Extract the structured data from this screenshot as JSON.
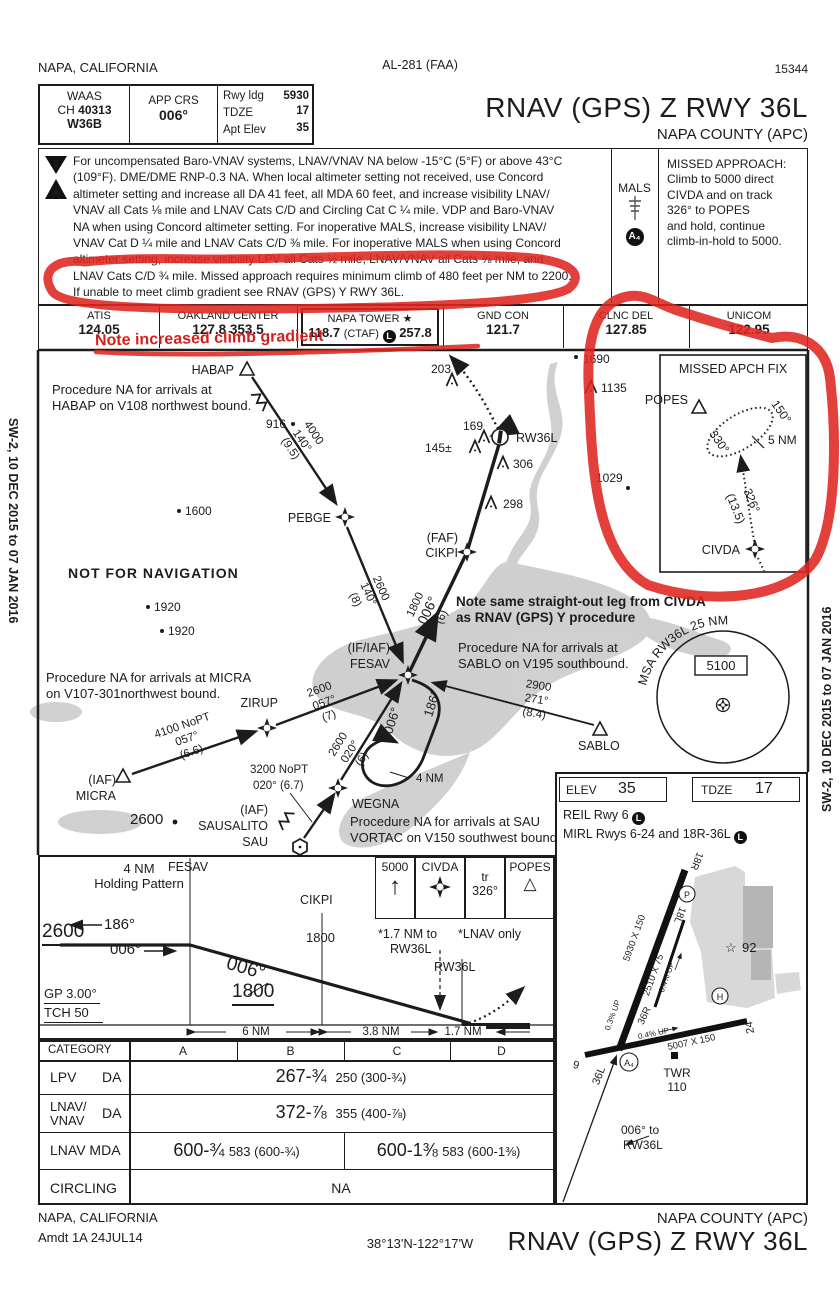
{
  "colors": {
    "red_marker": "#e02520",
    "red_print": "#d02420",
    "terrain": "#c9c9c9"
  },
  "margin": {
    "top_left": "NAPA, CALIFORNIA",
    "top_center": "AL-281 (FAA)",
    "top_right": "15344",
    "side_left": "SW-2, 10 DEC 2015 to 07 JAN 2016",
    "side_right": "SW-2, 10 DEC 2015 to 07 JAN 2016"
  },
  "header": {
    "waas": "WAAS",
    "ch_label": "CH",
    "ch_value": "40313",
    "waas_id": "W36B",
    "app_crs_label": "APP CRS",
    "app_crs_value": "006°",
    "rwy_ldg_label": "Rwy ldg",
    "rwy_ldg_value": "5930",
    "tdze_label": "TDZE",
    "tdze_value": "17",
    "apt_elev_label": "Apt Elev",
    "apt_elev_value": "35",
    "title": "RNAV (GPS) Z RWY 36L",
    "subtitle": "NAPA COUNTY (APC)"
  },
  "notes": {
    "t_icon": "T",
    "a_icon": "A",
    "lines": [
      "For uncompensated Baro-VNAV systems, LNAV/VNAV NA below -15°C (5°F) or above 43°C",
      "(109°F).  DME/DME RNP-0.3 NA.  When local altimeter setting not received, use Concord",
      "altimeter setting and increase all DA 41 feet, all MDA 60 feet, and increase visibility LNAV/",
      "VNAV all Cats ⅛ mile and LNAV Cats C/D and Circling Cat C ¼ mile.  VDP and  Baro-VNAV",
      "NA when using Concord altimeter setting.  For inoperative MALS, increase visibility LNAV/",
      "VNAV Cat D ¼ mile and LNAV Cats C/D ⅜ mile.  For inoperative MALS when using Concord",
      "altimeter setting, increase visibility LPV all Cats ½ mile, LNAV/VNAV all Cats ⅜ mile, and",
      "LNAV Cats C/D ¾ mile.  Missed approach requires minimum climb of 480 feet per NM to 2200.",
      "If unable to meet climb gradient see RNAV (GPS) Y RWY 36L."
    ],
    "mals": "MALS",
    "a4": "A₄",
    "missed_lines": [
      "MISSED APPROACH:",
      "Climb to 5000 direct",
      "CIVDA and on track",
      "326° to POPES",
      "and hold, continue",
      "climb-in-hold to 5000."
    ]
  },
  "freqs": {
    "atis_label": "ATIS",
    "atis": "124.05",
    "center_label": "OAKLAND CENTER",
    "center": "127.8 353.5",
    "tower_label": "NAPA TOWER",
    "tower_star": "★",
    "tower_pre": "118.7",
    "tower_ctaf": "(CTAF)",
    "tower_l": "L",
    "tower_post": "257.8",
    "gnd_label": "GND CON",
    "gnd": "121.7",
    "clnc_label": "CLNC DEL",
    "clnc": "127.85",
    "unicom_label": "UNICOM",
    "unicom": "122.95"
  },
  "red_notes": {
    "climb": "Note increased climb gradient",
    "civda1": "Note same straight-out leg from CIVDA",
    "civda2": "as RNAV (GPS) Y procedure",
    "nfn": "NOT FOR NAVIGATION"
  },
  "pv": {
    "note_habap1": "Procedure NA for arrivals at",
    "note_habap2": "HABAP on V108 northwest bound.",
    "note_micra1": "Procedure NA for arrivals at MICRA",
    "note_micra2": "on V107-301northwest bound.",
    "note_sablo1": "Procedure NA for arrivals at",
    "note_sablo2": "SABLO on V195 southbound.",
    "note_sau1": "Procedure NA for arrivals at SAU",
    "note_sau2": "VORTAC on V150 southwest bound.",
    "habap": "HABAP",
    "pebge": "PEBGE",
    "cikpi_role": "(FAF)",
    "cikpi": "CIKPI",
    "fesav_role": "(IF/IAF)",
    "fesav": "FESAV",
    "zirup": "ZIRUP",
    "micra_role": "(IAF)",
    "micra": "MICRA",
    "sau_role": "(IAF)",
    "sau_name": "SAUSALITO",
    "sau_id": "SAU",
    "wegna": "WEGNA",
    "sablo": "SABLO",
    "rw36l": "RW36L",
    "l1a": "4000",
    "l1c": "140°",
    "l1d": "(9.5)",
    "l2a": "2600",
    "l2c": "140°",
    "l2d": "(8)",
    "l3a": "1800",
    "l3c": "006°",
    "l3d": "(6)",
    "l4a": "2600",
    "l4c": "057°",
    "l4d": "(7)",
    "l5a": "4100 NoPT",
    "l5c": "057°",
    "l5d": "(6.6)",
    "l6a": "3200 NoPT",
    "l6b": "020° (6.7)",
    "l7a": "2600",
    "l7c": "020°",
    "l7d": "(6)",
    "hold_in": "006°",
    "hold_out": "186°",
    "hold_len": "4 NM",
    "l8a": "2900",
    "l8c": "271°",
    "l8d": "(8.4)",
    "e916": "916",
    "e1600": "1600",
    "e1920a": "1920",
    "e1920b": "1920",
    "e2600": "2600",
    "e203": "203",
    "e169": "169",
    "e145": "145±",
    "e306": "306",
    "e298": "298",
    "e1690": "1690",
    "e1135": "1135",
    "e1029": "1029",
    "msa_arc": "MSA RW36L 25 NM",
    "msa_alt": "5100"
  },
  "inset": {
    "title": "MISSED APCH FIX",
    "popes": "POPES",
    "out": "150°",
    "inb": "330°",
    "len": "5 NM",
    "crs": "326°",
    "dist": "(13.5)",
    "civda": "CIVDA"
  },
  "profile": {
    "hold1": "4 NM",
    "hold2": "Holding Pattern",
    "fesav": "FESAV",
    "alt": "2600",
    "out": "186°",
    "inb": "006°",
    "fac": "006°",
    "cikpi": "CIKPI",
    "cikpi_alt": "1800",
    "gs_alt": "1800",
    "gp": "GP 3.00°",
    "tch": "TCH 50",
    "m1": "5000",
    "m2": "CIVDA",
    "m3a": "tr",
    "m3b": "326°",
    "m4": "POPES",
    "vdp1": "*1.7 NM to",
    "vdp2": "RW36L",
    "lnav": "*LNAV only",
    "rw": "RW36L",
    "d1": "6 NM",
    "d2": "3.8 NM",
    "d3": "1.7 NM"
  },
  "minimums": {
    "h_cat": "CATEGORY",
    "h_a": "A",
    "h_b": "B",
    "h_c": "C",
    "h_d": "D",
    "r1n": "LPV",
    "r1t": "DA",
    "r1v": "267-¾",
    "r1s": "250 (300-¾)",
    "r2n1": "LNAV/",
    "r2n2": "VNAV",
    "r2t": "DA",
    "r2v": "372-⅞",
    "r2s": "355 (400-⅞)",
    "r3n": "LNAV MDA",
    "r3v1": "600-¾",
    "r3s1": "583 (600-¾)",
    "r3v2": "600-1⅜",
    "r3s2": "583 (600-1⅜)",
    "r4n": "CIRCLING",
    "r4v": "NA"
  },
  "sketch": {
    "elev_l": "ELEV",
    "elev": "35",
    "tdze_l": "TDZE",
    "tdze": "17",
    "reil": "REIL Rwy 6",
    "l": "L",
    "mirl": "MIRL Rwys 6-24 and 18R-36L",
    "r18r": "18R",
    "r18l": "18L",
    "r36r": "36R",
    "r36l": "36L",
    "r6": "6",
    "r24": "24",
    "dim1": "5930 X 150",
    "dim2": "2510 X 75",
    "dim3": "5007 X 150",
    "s1": "0.3% UP",
    "s2": "0.4% UP",
    "s3": "0.4% UP",
    "twr1": "TWR",
    "twr2": "110",
    "fe_star": "☆",
    "fe": "92",
    "a4": "A₄",
    "h": "H",
    "p": "P",
    "app1": "006° to",
    "app2": "RW36L"
  },
  "footer": {
    "city": "NAPA, CALIFORNIA",
    "amdt": "Amdt 1A  24JUL14",
    "coords": "38°13'N-122°17'W",
    "airport": "NAPA COUNTY (APC)",
    "title": "RNAV (GPS) Z RWY 36L"
  }
}
